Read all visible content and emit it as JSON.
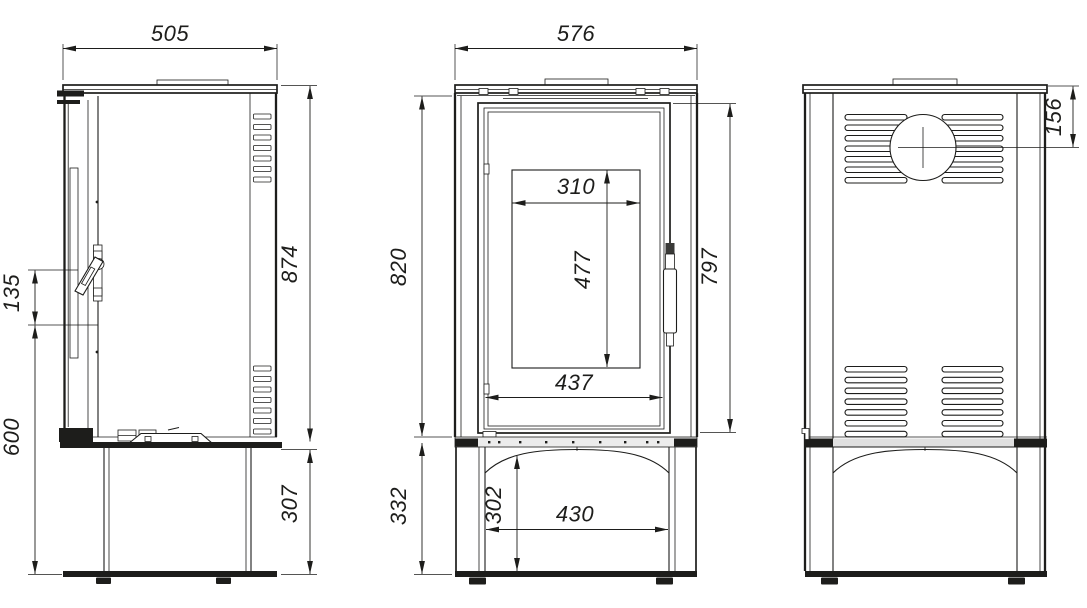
{
  "drawing": {
    "background_color": "#ffffff",
    "line_color": "#1d1d1b",
    "views": {
      "side": {
        "dims": {
          "width": "505",
          "height": "874",
          "handle_span": "135",
          "handle_height": "600",
          "base_height": "307"
        }
      },
      "front": {
        "dims": {
          "width": "576",
          "body_height": "820",
          "glass_width": "310",
          "glass_height": "477",
          "door_width": "437",
          "door_height": "797",
          "base_height": "332",
          "base_opening_height": "302",
          "base_width": "430"
        }
      },
      "back": {
        "dims": {
          "flue_center_from_top": "156"
        }
      }
    }
  }
}
